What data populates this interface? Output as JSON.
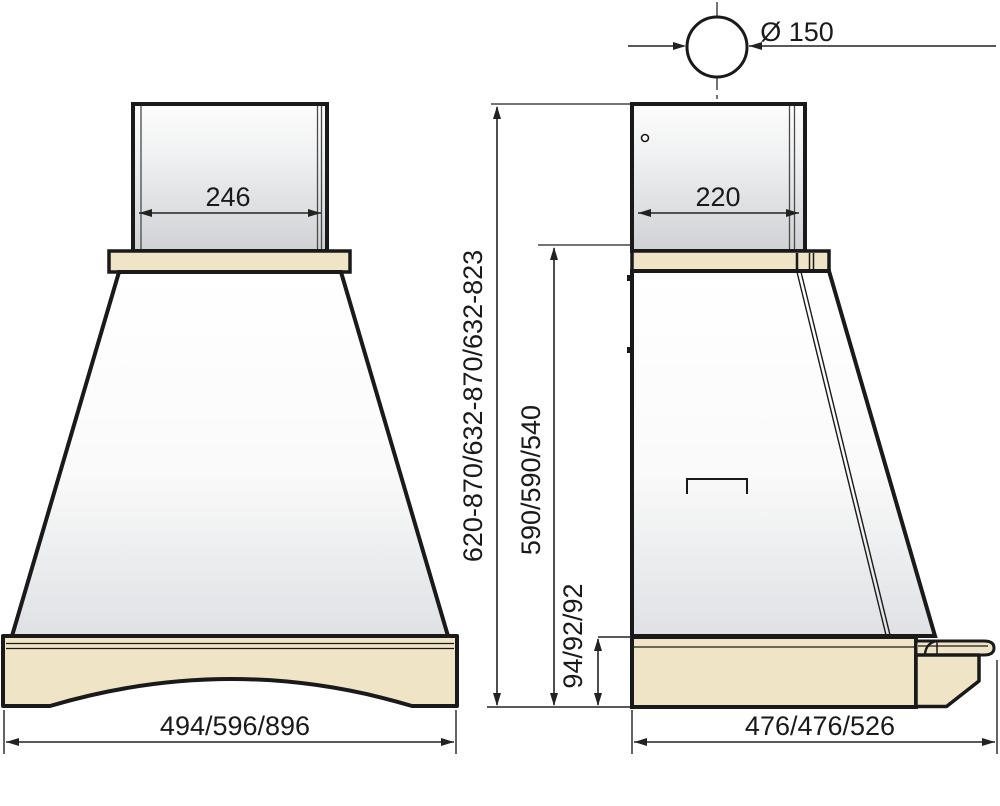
{
  "drawing": {
    "type": "range-hood-dimension-drawing",
    "dims": {
      "duct_diameter": "Ø 150",
      "chimney_width": "246",
      "chimney_depth": "220",
      "overall_height": "620-870/632-870/632-823",
      "body_height": "590/590/540",
      "base_height": "94/92/92",
      "overall_width": "494/596/896",
      "overall_depth": "476/476/526"
    },
    "colors": {
      "wood": "#efe4c6",
      "outline": "#1a1a1a",
      "dimension": "#222222"
    }
  }
}
